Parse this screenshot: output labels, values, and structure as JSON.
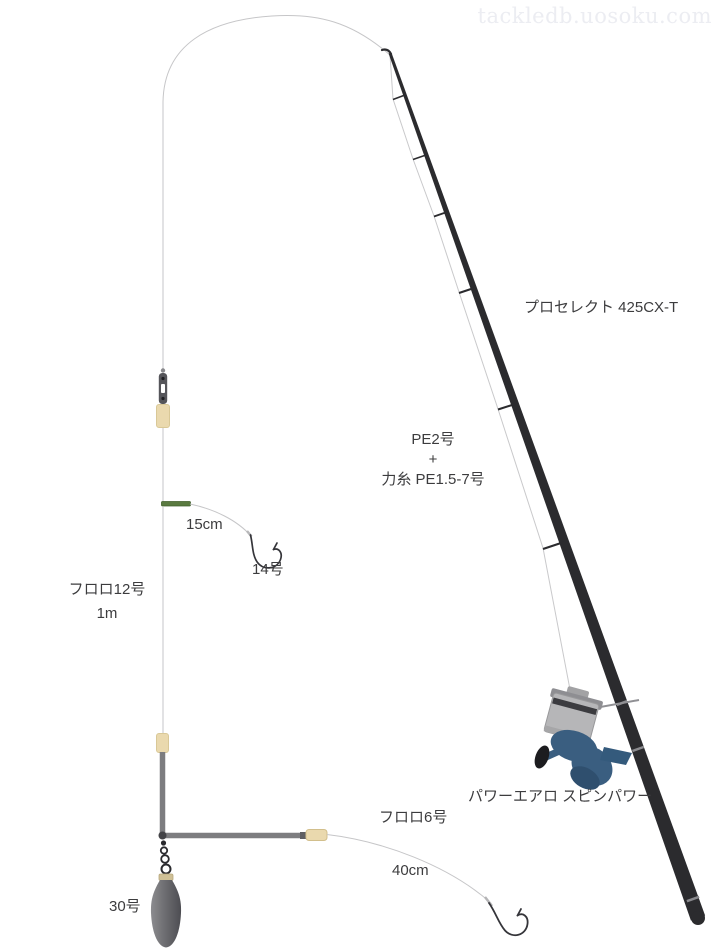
{
  "watermark": "tackledb.uosoku.com",
  "rod": {
    "label": "プロセレクト 425CX-T"
  },
  "reel": {
    "label": "パワーエアロ スピンパワー"
  },
  "main_line": {
    "line1": "PE2号",
    "line2": "+",
    "line3": "力糸 PE1.5-7号"
  },
  "leader": {
    "material": "フロロ12号",
    "length": "1m"
  },
  "upper_branch": {
    "length": "15cm",
    "hook": "14号"
  },
  "lower_branch": {
    "material": "フロロ6号",
    "length": "40cm"
  },
  "sinker": {
    "label": "30号"
  },
  "colors": {
    "rod": "#2b2b2e",
    "line": "#c6c6c8",
    "arm": "#7d7d80",
    "branch_stopper_green": "#5a7a40",
    "bead_beige": "#ead9ae",
    "sinker_gray": "#6a6a6e",
    "reel_blue": "#3a5e80",
    "text": "#3c3c3e",
    "watermark": "#ecedf2"
  }
}
